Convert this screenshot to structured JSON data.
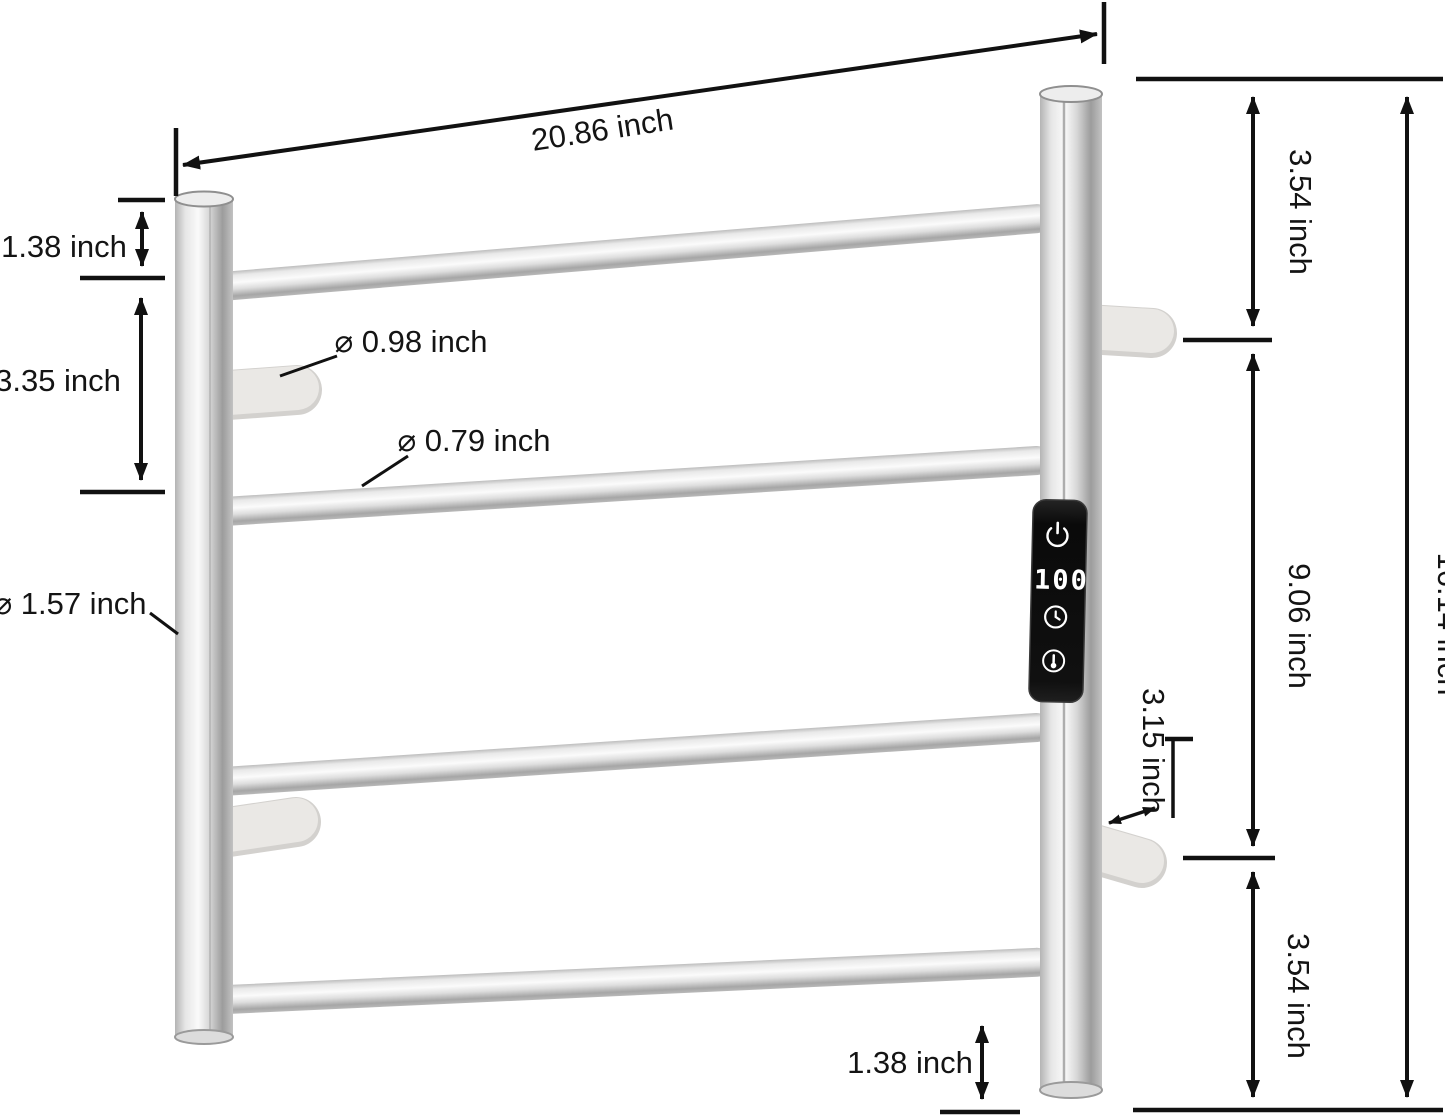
{
  "diagram": {
    "background": "#ffffff",
    "line_color": "#111111",
    "dims": {
      "top_width": "20.86 inch",
      "left_top": "1.38 inch",
      "left_span": "3.35 inch",
      "peg_dia": "⌀ 0.98 inch",
      "rung_dia": "⌀ 0.79 inch",
      "post_dia": "⌀ 1.57 inch",
      "right_top": "3.54 inch",
      "right_span": "9.06 inch",
      "right_bottom": "3.54 inch",
      "total_height": "16.14 inch",
      "standoff": "3.15 inch",
      "bottom_gap": "1.38 inch"
    },
    "panel": {
      "display_value": "100",
      "panel_color": "#101010",
      "led_color": "#ffffff",
      "icons": [
        "power-icon",
        "timer-icon",
        "temperature-icon"
      ]
    },
    "materials": {
      "tube_highlight": "#fbfbfb",
      "tube_shadow": "#9c9c9c",
      "peg_color": "#eae8e5"
    }
  }
}
